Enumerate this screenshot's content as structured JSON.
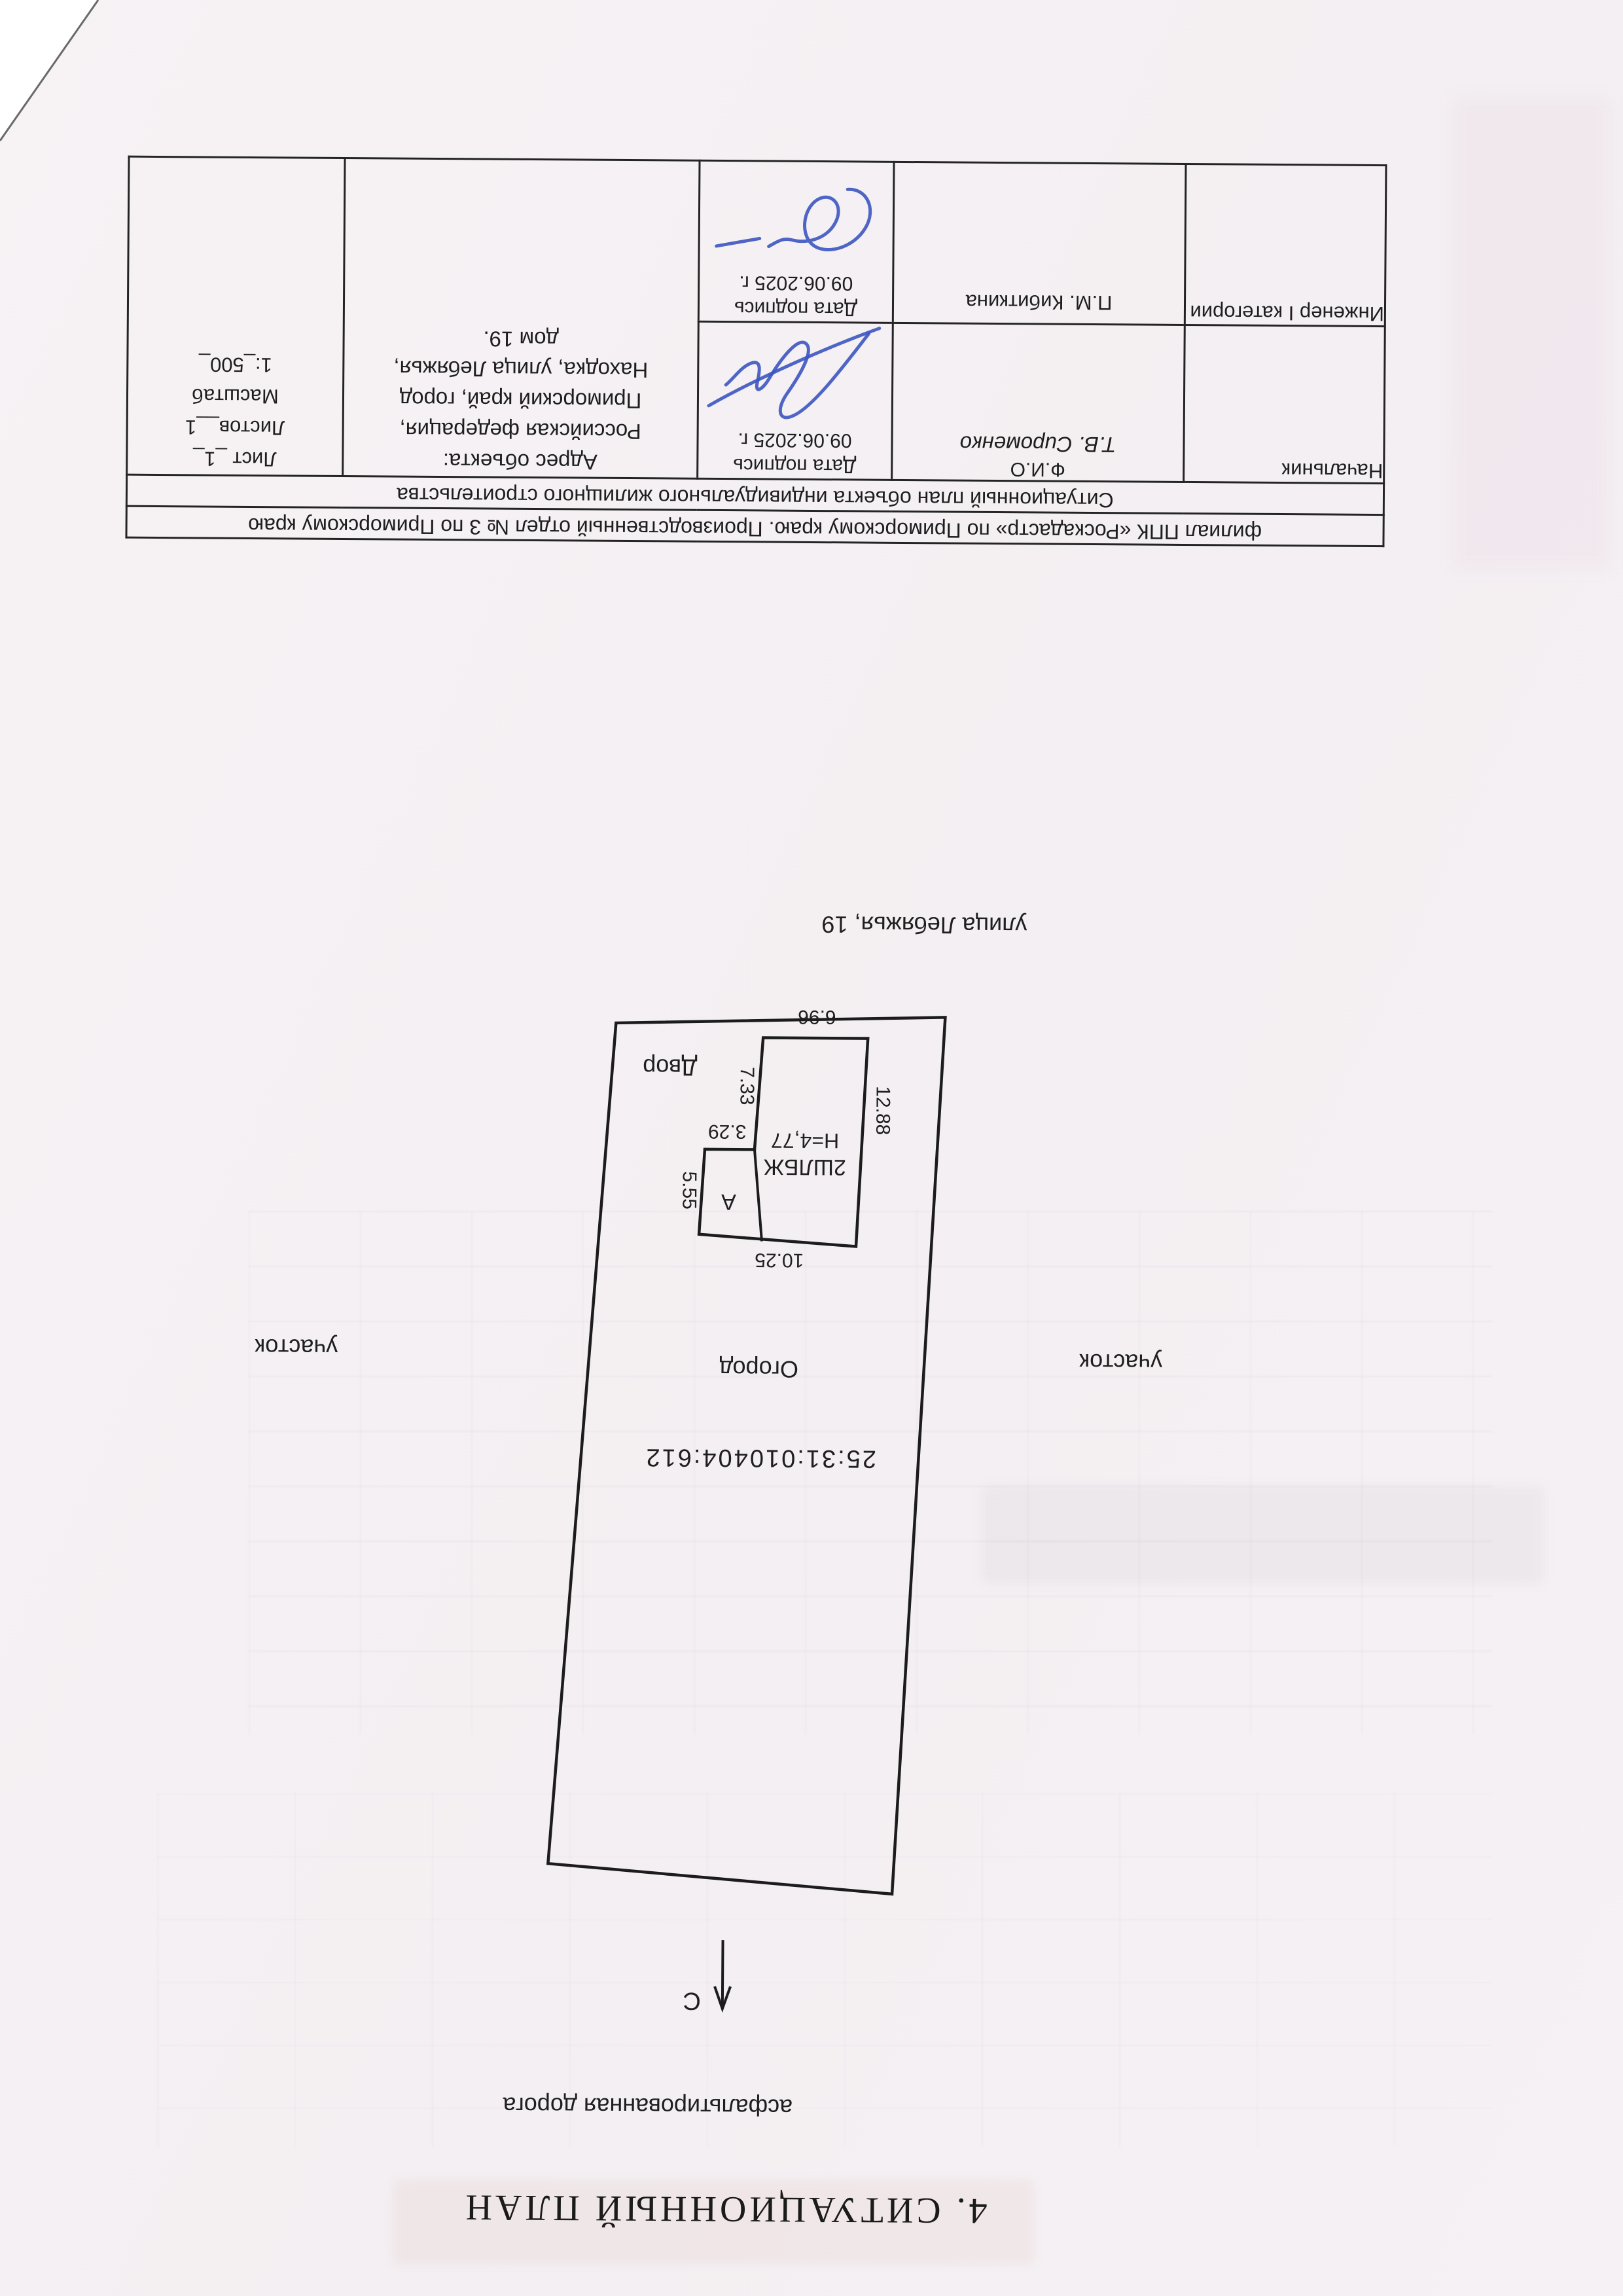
{
  "document": {
    "title": "4. СИТУАЦИОННЫЙ ПЛАН",
    "road_label": "асфальтированная дорога",
    "street_label": "улица Лебяжья, 19",
    "north_label": "С"
  },
  "plan": {
    "cadastral_number": "25:31:010404:612",
    "garden_label": "Огород",
    "yard_label": "Двор",
    "parcel_label_left": "участок",
    "parcel_label_right": "участок",
    "building_label": "2ШЛБЖ",
    "building_height": "Н=4,77",
    "annex_label": "А",
    "dimensions": {
      "top": "10.25",
      "bottom": "6.96",
      "left": "12.88",
      "right_upper": "5.55",
      "step": "3.29",
      "right_lower": "7.33"
    }
  },
  "title_block": {
    "org_row": "филиал ППК «Роскадастр» по Приморскому краю. Производственный отдел № 3 по Приморскому краю",
    "plan_row": "Ситуационный план объекта индивидуального жилищного строительства",
    "rows": [
      {
        "position": "Начальник",
        "fio_label": "Ф.И.О",
        "fio": "Т.В. Сироменко",
        "date_label": "Дата подпись",
        "date": "09.06.2025 г."
      },
      {
        "position": "Инженер I категории",
        "fio": "П.М. Кибиткина",
        "date_label": "Дата подпись",
        "date": "09.06.2025 г."
      }
    ],
    "address_label": "Адрес объекта:",
    "address_lines": {
      "0": "Российская федерация,",
      "1": "Приморский край, город",
      "2": "Находка, улица Лебяжья,",
      "3": "дом 19."
    },
    "sheet": {
      "list": "Лист _1_",
      "listov": "Листов__1",
      "scale_label": "Масштаб",
      "scale": "1:_500_"
    }
  }
}
